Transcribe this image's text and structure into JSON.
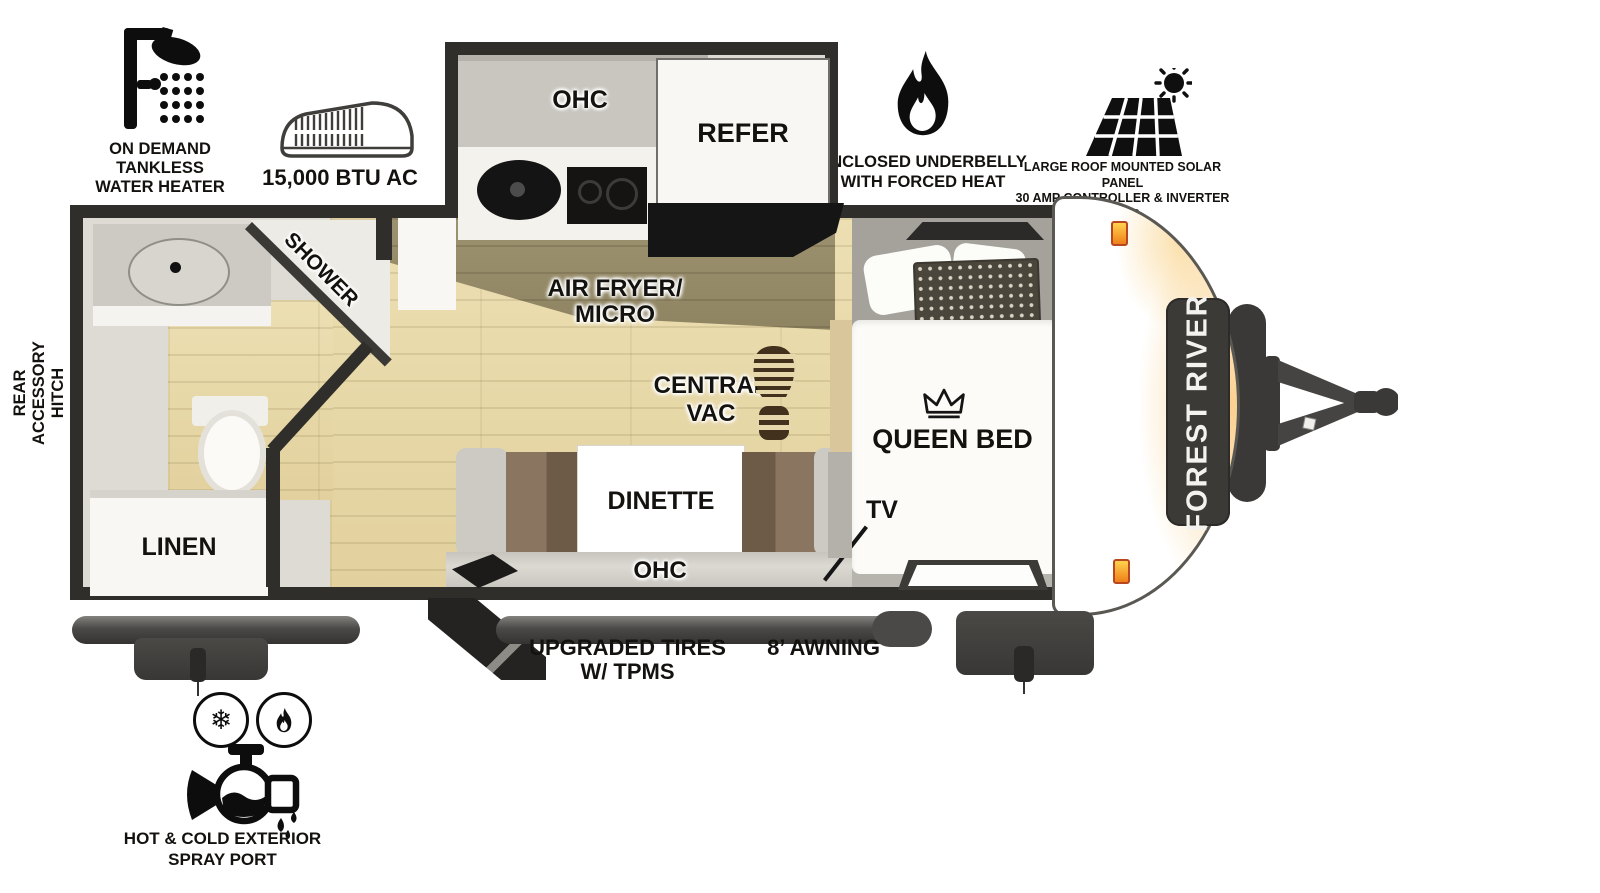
{
  "callouts": {
    "water_heater": {
      "lines": [
        "ON DEMAND",
        "TANKLESS",
        "WATER HEATER"
      ]
    },
    "ac": {
      "label": "15,000 BTU AC"
    },
    "underbelly": {
      "lines": [
        "ENCLOSED UNDERBELLY",
        "WITH FORCED HEAT"
      ]
    },
    "solar": {
      "lines": [
        "LARGE ROOF MOUNTED SOLAR PANEL",
        "30 AMP CONTROLLER & INVERTER PREP"
      ]
    },
    "rear_hitch": {
      "lines": [
        "REAR",
        "ACCESSORY",
        "HITCH"
      ]
    },
    "tires": {
      "lines": [
        "UPGRADED TIRES",
        "W/ TPMS"
      ]
    },
    "awning": {
      "label": "8’ AWNING"
    },
    "spray_port": {
      "lines": [
        "HOT & COLD EXTERIOR",
        "SPRAY PORT"
      ]
    }
  },
  "interior": {
    "galley_ohc": "OHC",
    "refer": "REFER",
    "air_fryer_micro": {
      "lines": [
        "AIR FRYER/",
        "MICRO"
      ]
    },
    "central_vac": {
      "lines": [
        "CENTRAL",
        "VAC"
      ]
    },
    "dinette": "DINETTE",
    "dinette_ohc": "OHC",
    "queen_bed": "QUEEN BED",
    "tv": "TV",
    "shower": "SHOWER",
    "linen": "LINEN"
  },
  "brand": {
    "logo_text": "FOREST RIVER"
  },
  "colors": {
    "wall": "#2f2e2b",
    "floor_tan": "#e7d8ac",
    "accent_orange": "#f2a93b",
    "marker_light": "#f08c1d",
    "badge": "#3b3a37"
  }
}
